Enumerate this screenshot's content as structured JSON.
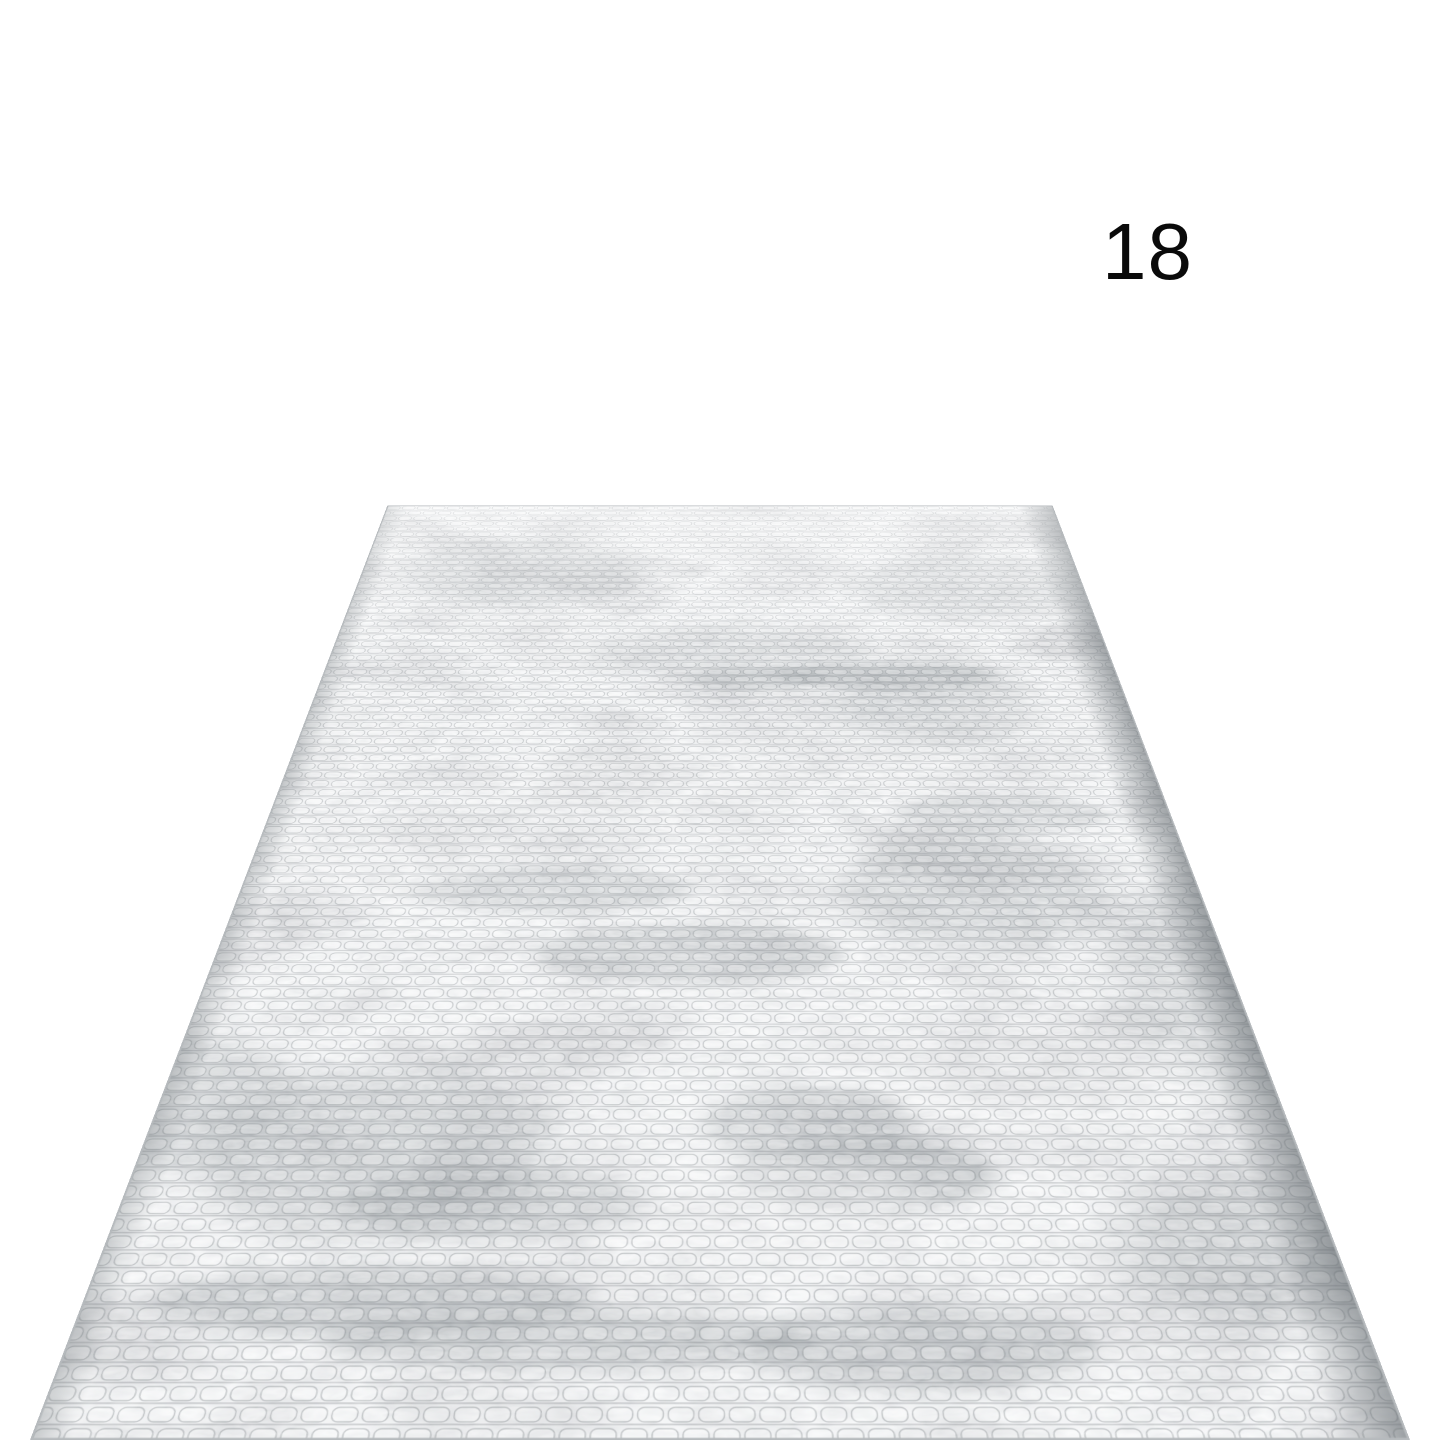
{
  "canvas": {
    "width": 1440,
    "height": 1440,
    "background": "#ffffff"
  },
  "label": {
    "text": "18",
    "color": "#0a0a0a"
  },
  "rug": {
    "alt": "Gray abstract textured area rug shown in angled perspective on a white backdrop",
    "colors": {
      "base": "#d8dadb",
      "light": "#eceded",
      "mid": "#bcc0c3",
      "dark": "#999fa3",
      "edge_shadow": "#82898d",
      "border": "#b6babd"
    }
  }
}
